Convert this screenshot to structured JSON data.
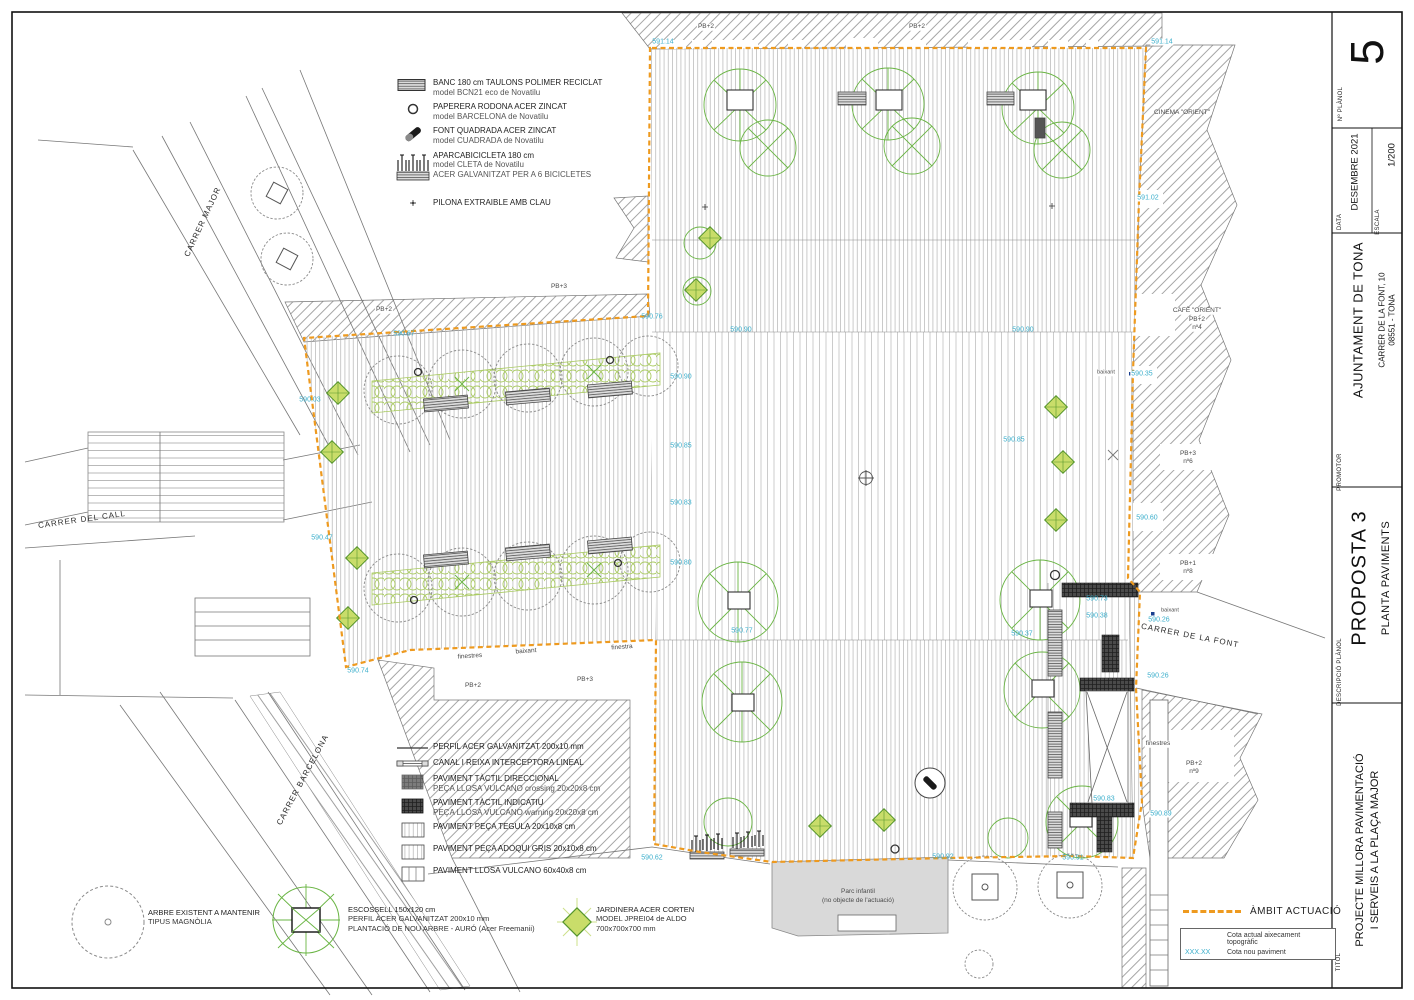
{
  "titleblock": {
    "num_label": "Nº PLÀNOL",
    "num": "5",
    "data_label": "DATA",
    "data_value": "DESEMBRE 2021",
    "escala_label": "ESCALA",
    "escala_value": "1/200",
    "promotor_label": "PROMOTOR",
    "promotor_value": "AJUNTAMENT DE TONA",
    "promotor_addr1": "CARRER DE LA FONT, 10",
    "promotor_addr2": "08551  -  TONA",
    "descripcio_label": "DESCRIPCIÓ PLÀNOL",
    "descripcio_value1": "PROPOSTA 3",
    "descripcio_value2": "PLANTA PAVIMENTS",
    "titol_label": "TITOL",
    "titol_value1": "PROJECTE MILLORA PAVIMENTACIÓ",
    "titol_value2": "I SERVEIS A LA PLAÇA MAJOR"
  },
  "legend_mobiliari": {
    "banc": {
      "l1": "BANC 180 cm TAULONS POLIMER RECICLAT",
      "l2": "model BCN21 eco de Novatilu"
    },
    "paperera": {
      "l1": "PAPERERA RODONA ACER ZINCAT",
      "l2": "model BARCELONA de Novatilu"
    },
    "font": {
      "l1": "FONT QUADRADA ACER ZINCAT",
      "l2": "model CUADRADA de Novatilu"
    },
    "aparcabicicleta": {
      "l1": "APARCABICICLETA 180 cm",
      "l2": "model CLETA de Novatilu",
      "l3": "ACER GALVANITZAT PER A 6 BICICLETES"
    },
    "pilona": {
      "l1": "PILONA EXTRAIBLE AMB CLAU"
    }
  },
  "legend_paviments": {
    "perfil": {
      "l1": "PERFIL ACER GALVANITZAT 200x10 mm"
    },
    "canal": {
      "l1": "CANAL I REIXA INTERCEPTORA LINEAL"
    },
    "tactil_dir": {
      "l1": "PAVIMENT TÀCTIL DIRECCIONAL",
      "l2": "PEÇA LLOSA VULCANO crossing 20x20x8 cm"
    },
    "tactil_ind": {
      "l1": "PAVIMENT TÀCTIL INDICATIU",
      "l2": "PEÇA LLOSA VULCANO warning 20x20x8 cm"
    },
    "tegula": {
      "l1": "PAVIMENT PEÇA TEGULA 20x10x8 cm"
    },
    "adoqui": {
      "l1": "PAVIMENT PEÇA ADOQUI GRIS 20x10x8 cm"
    },
    "llosa": {
      "l1": "PAVIMENT LLOSA VULCANO 60x40x8 cm"
    }
  },
  "legend_verd": {
    "arbre": {
      "l1": "ARBRE EXISTENT A MANTENIR",
      "l2": "TIPUS MAGNÒLIA"
    },
    "escossell": {
      "l1": "ESCOSSELL 150x120 cm",
      "l2": "PERFIL ACER GALVANITZAT 200x10 mm",
      "l3": "PLANTACIÓ DE NOU ARBRE - AURÓ (Acer Freemanii)"
    },
    "jardinera": {
      "l1": "JARDINERA ACER CORTEN",
      "l2": "MODEL JPREI04 de ALDO",
      "l3": "700x700x700 mm"
    }
  },
  "legend_ambit": {
    "label": "ÀMBIT ACTUACIÓ",
    "row1_label": "Cota actual aixecament topogràfic",
    "row2_value": "XXX.XX",
    "row2_label": "Cota nou paviment"
  },
  "colors": {
    "ambit_orange": "#EE9A1F",
    "cota_cyan": "#3aaecb",
    "green_new": "#6ab544",
    "green_diamond_fill": "#c9dd6a"
  },
  "plan": {
    "streets": [
      {
        "t": "CARRER MAJOR",
        "x": 203,
        "y": 222,
        "r": -65
      },
      {
        "t": "CARRER DEL CALL",
        "x": 82,
        "y": 520,
        "r": -8
      },
      {
        "t": "CARRER BARCELONA",
        "x": 303,
        "y": 780,
        "r": -62
      },
      {
        "t": "CARRER DE LA FONT",
        "x": 1190,
        "y": 636,
        "r": 11
      }
    ],
    "labels": [
      {
        "t": "PB+2",
        "x": 706,
        "y": 27,
        "bg": 1
      },
      {
        "t": "PB+2",
        "x": 917,
        "y": 27,
        "bg": 1
      },
      {
        "t": "CINEMA \"ORIENT\"",
        "x": 1182,
        "y": 113
      },
      {
        "t": "CAFÈ \"ORIENT\"",
        "x": 1197,
        "y": 311,
        "bg": 1
      },
      {
        "t": "PB+2",
        "x": 1197,
        "y": 320,
        "bg": 1
      },
      {
        "t": "nº4",
        "x": 1197,
        "y": 328,
        "bg": 1
      },
      {
        "t": "PB+3",
        "x": 1188,
        "y": 454,
        "bg": 1
      },
      {
        "t": "nº6",
        "x": 1188,
        "y": 462,
        "bg": 1
      },
      {
        "t": "PB+1",
        "x": 1188,
        "y": 564,
        "bg": 1
      },
      {
        "t": "nº8",
        "x": 1188,
        "y": 572,
        "bg": 1
      },
      {
        "t": "PB+2",
        "x": 1194,
        "y": 764,
        "bg": 1
      },
      {
        "t": "nº9",
        "x": 1194,
        "y": 772,
        "bg": 1
      },
      {
        "t": "finestres",
        "x": 1158,
        "y": 744,
        "bg": 1
      },
      {
        "t": "baixant",
        "x": 1106,
        "y": 373,
        "s": 5.5,
        "bg": 1
      },
      {
        "t": "baixant",
        "x": 1170,
        "y": 611,
        "s": 5.5,
        "bg": 1
      },
      {
        "t": "finestres",
        "x": 470,
        "y": 657,
        "r": -4
      },
      {
        "t": "baixant",
        "x": 526,
        "y": 652,
        "r": -4
      },
      {
        "t": "finestra",
        "x": 622,
        "y": 648,
        "r": -4
      },
      {
        "t": "PB+2",
        "x": 473,
        "y": 686
      },
      {
        "t": "PB+3",
        "x": 585,
        "y": 680
      },
      {
        "t": "PB+2",
        "x": 384,
        "y": 310,
        "bg": 1
      },
      {
        "t": "PB+3",
        "x": 559,
        "y": 287,
        "bg": 1
      },
      {
        "t": "Parc infantil",
        "x": 858,
        "y": 892
      },
      {
        "t": "(no objecte de l'actuació)",
        "x": 858,
        "y": 901
      }
    ],
    "elevations": [
      {
        "t": "591.14",
        "x": 663,
        "y": 42
      },
      {
        "t": "591.14",
        "x": 1162,
        "y": 42,
        "bg": 1
      },
      {
        "t": "591.02",
        "x": 1148,
        "y": 198,
        "bg": 1
      },
      {
        "t": "590.90",
        "x": 741,
        "y": 330
      },
      {
        "t": "590.90",
        "x": 1023,
        "y": 330
      },
      {
        "t": "590.90",
        "x": 681,
        "y": 377
      },
      {
        "t": "590.85",
        "x": 681,
        "y": 446
      },
      {
        "t": "590.83",
        "x": 681,
        "y": 503
      },
      {
        "t": "590.80",
        "x": 681,
        "y": 563
      },
      {
        "t": "590.77",
        "x": 742,
        "y": 631
      },
      {
        "t": "590.85",
        "x": 1014,
        "y": 440
      },
      {
        "t": "590.37",
        "x": 1022,
        "y": 634
      },
      {
        "t": "590.60",
        "x": 1147,
        "y": 518,
        "bg": 1
      },
      {
        "t": "590.35",
        "x": 1142,
        "y": 374,
        "bg": 1
      },
      {
        "t": "590.03",
        "x": 310,
        "y": 400
      },
      {
        "t": "590.47",
        "x": 322,
        "y": 538
      },
      {
        "t": "590.74",
        "x": 358,
        "y": 671
      },
      {
        "t": "590.67",
        "x": 404,
        "y": 334
      },
      {
        "t": "590.76",
        "x": 652,
        "y": 317
      },
      {
        "t": "590.73",
        "x": 1097,
        "y": 599
      },
      {
        "t": "590.38",
        "x": 1097,
        "y": 616
      },
      {
        "t": "590.26",
        "x": 1159,
        "y": 620,
        "bg": 1
      },
      {
        "t": "590.26",
        "x": 1158,
        "y": 676,
        "bg": 1
      },
      {
        "t": "590.83",
        "x": 1104,
        "y": 799
      },
      {
        "t": "590.89",
        "x": 1161,
        "y": 814,
        "bg": 1
      },
      {
        "t": "590.62",
        "x": 652,
        "y": 858
      },
      {
        "t": "590.92",
        "x": 943,
        "y": 857
      },
      {
        "t": "590.91",
        "x": 1073,
        "y": 858
      }
    ]
  }
}
